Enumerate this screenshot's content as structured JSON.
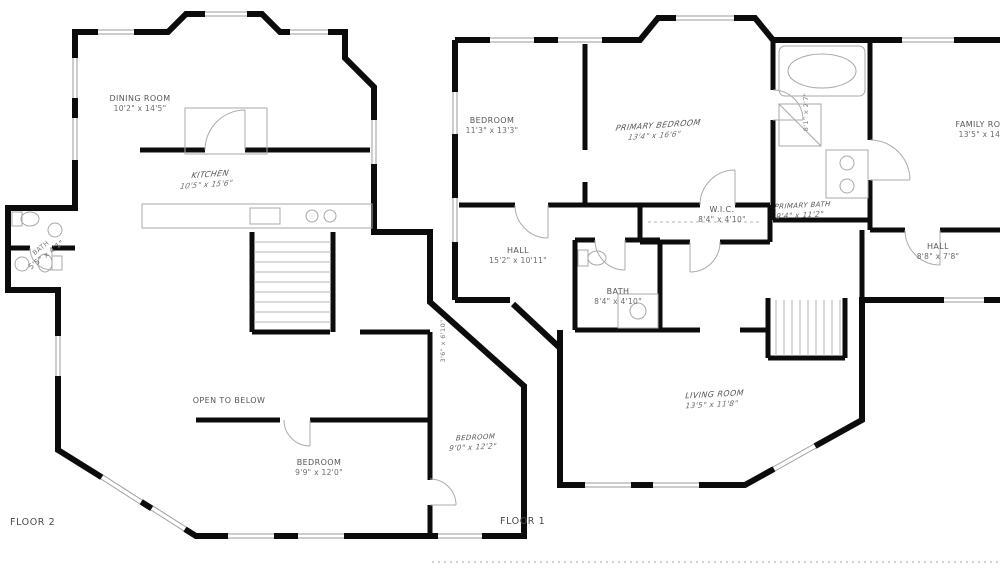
{
  "colors": {
    "background": "#ffffff",
    "walls": "#0c0c0c",
    "details": "#a8a8a8",
    "label_text": "#565656"
  },
  "floors": [
    {
      "title": "FLOOR 2",
      "rooms": [
        {
          "name": "DINING ROOM",
          "dims": "10'2\" x 14'5\""
        },
        {
          "name": "KITCHEN",
          "dims": "10'5\" x 15'6\""
        },
        {
          "name": "BATH",
          "dims": "5'5\" x 4'1\""
        },
        {
          "name": "OPEN TO BELOW",
          "dims": ""
        },
        {
          "name": "BEDROOM",
          "dims": "9'9\" x 12'0\""
        },
        {
          "name": "BEDROOM",
          "dims": "9'0\" x 12'2\""
        }
      ]
    },
    {
      "title": "FLOOR 1",
      "rooms": [
        {
          "name": "BEDROOM",
          "dims": "11'3\" x 13'3\""
        },
        {
          "name": "PRIMARY BEDROOM",
          "dims": "13'4\" x 16'6\""
        },
        {
          "name": "PRIMARY BATH",
          "dims": "9'4\" x 11'2\""
        },
        {
          "name": "FAMILY ROOM",
          "dims": "13'5\" x 14'6\""
        },
        {
          "name": "W.I.C.",
          "dims": "8'4\" x 4'10\""
        },
        {
          "name": "HALL",
          "dims": "15'2\" x 10'11\""
        },
        {
          "name": "BATH",
          "dims": "8'4\" x 4'10\""
        },
        {
          "name": "HALL",
          "dims": "8'8\" x 7'8\""
        },
        {
          "name": "LIVING ROOM",
          "dims": "13'5\" x 11'8\""
        }
      ]
    }
  ],
  "small_labels": [
    {
      "text": "3'6\" x 6'10\""
    },
    {
      "text": "8'1\" x 2'7\""
    }
  ]
}
